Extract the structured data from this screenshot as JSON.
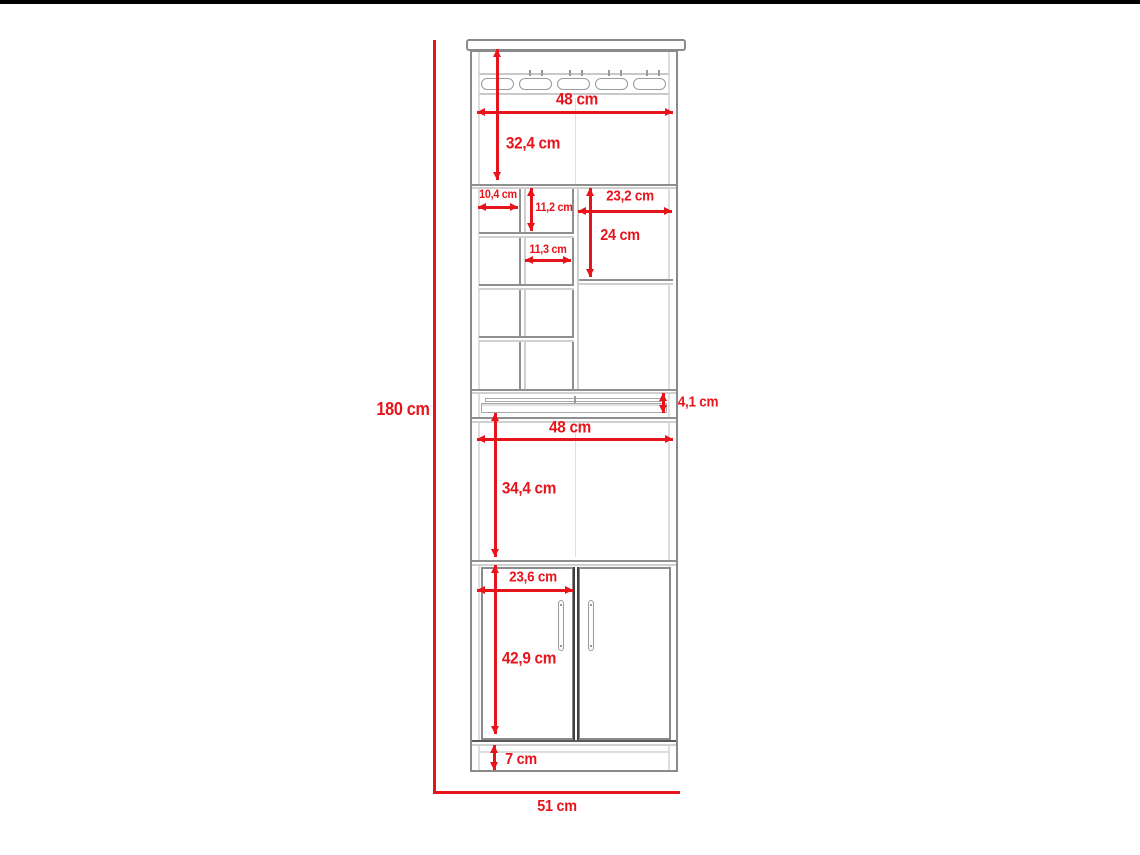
{
  "title": "Bar cabinet dimensional drawing",
  "units": "cm",
  "colors": {
    "dimension_red": "#e8141c",
    "cabinet_line": "#8f8f8f",
    "cabinet_line_light": "#d0d0d0",
    "cabinet_line_dark": "#3f3f3f",
    "background": "#ffffff",
    "frame_black": "#000000"
  },
  "overall": {
    "height_label": "180 cm",
    "width_label": "51 cm"
  },
  "dimensions": [
    {
      "name": "glassrack-section-width",
      "label": "48 cm",
      "type": "h",
      "x1": 477,
      "x2": 673,
      "y": 112,
      "lx": 577,
      "ly": 99,
      "fs": 17
    },
    {
      "name": "top-section-height",
      "label": "32,4 cm",
      "type": "v",
      "x": 497,
      "y1": 49,
      "y2": 180,
      "lx": 533,
      "ly": 143,
      "fs": 17
    },
    {
      "name": "left-column-width",
      "label": "10,4 cm",
      "type": "h",
      "x1": 478,
      "x2": 518,
      "y": 207,
      "lx": 498,
      "ly": 194,
      "fs": 12
    },
    {
      "name": "middle-column-height",
      "label": "11,2 cm",
      "type": "v",
      "x": 531,
      "y1": 188,
      "y2": 231,
      "lx": 554,
      "ly": 207,
      "fs": 12
    },
    {
      "name": "right-column-width",
      "label": "23,2 cm",
      "type": "h",
      "x1": 578,
      "x2": 672,
      "y": 211,
      "lx": 630,
      "ly": 196,
      "fs": 15
    },
    {
      "name": "right-column-height",
      "label": "24 cm",
      "type": "v",
      "x": 590,
      "y1": 188,
      "y2": 277,
      "lx": 620,
      "ly": 236,
      "fs": 16
    },
    {
      "name": "middle-column-width",
      "label": "11,3 cm",
      "type": "h",
      "x1": 525,
      "x2": 571,
      "y": 260,
      "lx": 548,
      "ly": 249,
      "fs": 12
    },
    {
      "name": "ledge-height",
      "label": "4,1 cm",
      "type": "v",
      "x": 663,
      "y1": 393,
      "y2": 413,
      "lx": 698,
      "ly": 402,
      "fs": 15
    },
    {
      "name": "middle-section-width",
      "label": "48 cm",
      "type": "h",
      "x1": 477,
      "x2": 673,
      "y": 439,
      "lx": 570,
      "ly": 427,
      "fs": 17
    },
    {
      "name": "middle-section-height",
      "label": "34,4 cm",
      "type": "v",
      "x": 495,
      "y1": 413,
      "y2": 557,
      "lx": 529,
      "ly": 488,
      "fs": 17
    },
    {
      "name": "door-width",
      "label": "23,6 cm",
      "type": "h",
      "x1": 477,
      "x2": 573,
      "y": 590,
      "lx": 533,
      "ly": 577,
      "fs": 15
    },
    {
      "name": "door-height",
      "label": "42,9 cm",
      "type": "v",
      "x": 495,
      "y1": 565,
      "y2": 734,
      "lx": 529,
      "ly": 658,
      "fs": 17
    },
    {
      "name": "kick-height",
      "label": "7 cm",
      "type": "v",
      "x": 494,
      "y1": 745,
      "y2": 770,
      "lx": 521,
      "ly": 760,
      "fs": 16
    },
    {
      "name": "overall-height",
      "label": "180 cm",
      "type": "label",
      "lx": 403,
      "ly": 409,
      "fs": 18
    },
    {
      "name": "overall-width",
      "label": "51 cm",
      "type": "label",
      "lx": 557,
      "ly": 807,
      "fs": 16
    }
  ]
}
